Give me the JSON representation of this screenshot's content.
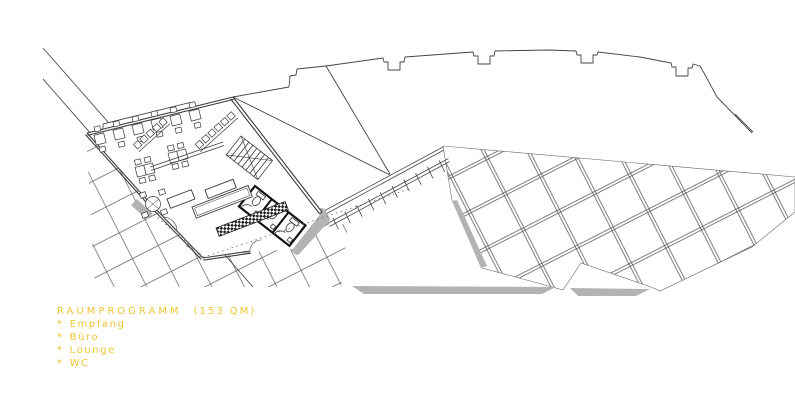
{
  "legend": {
    "title": "RAUMPROGRAMM",
    "area": "(153 QM)",
    "bullet": "*",
    "items": [
      "Empfang",
      "Büro",
      "Lounge",
      "WC"
    ],
    "color": "#eec734"
  },
  "drawing": {
    "line_color": "#3f3f3f",
    "grid_line_color": "#555555",
    "shadow_color": "#b3b3b3",
    "background_color": "#ffffff"
  }
}
